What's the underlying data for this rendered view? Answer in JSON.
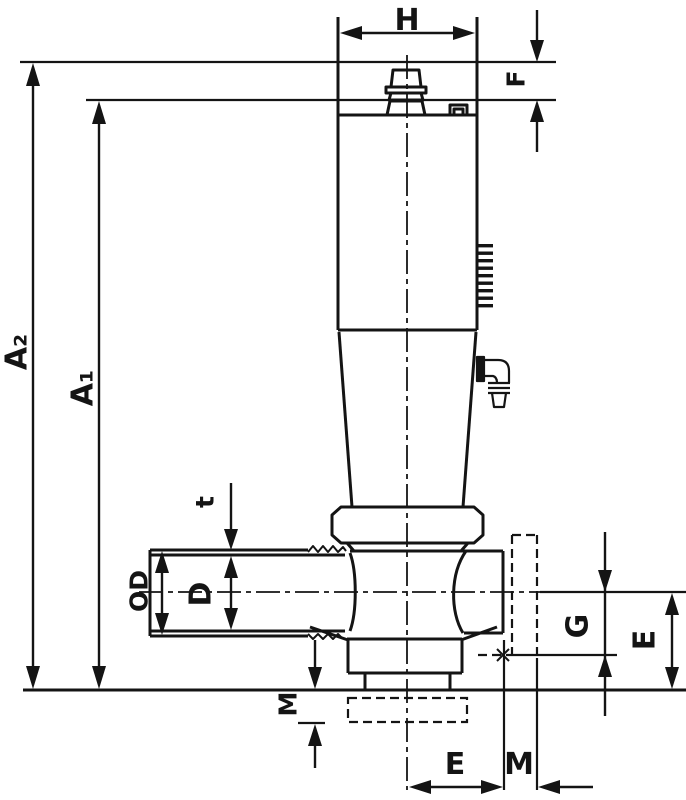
{
  "diagram": {
    "type": "technical-dimension-drawing",
    "subject": "angle-seat valve with side and bottom ports",
    "colors": {
      "line": "#141414",
      "background": "#ffffff"
    },
    "labels": {
      "H": "H",
      "F": "F",
      "A2": "A₂",
      "A1": "A₁",
      "t": "t",
      "OD": "OD",
      "D": "D",
      "G": "G",
      "E_side": "E",
      "E_bottom": "E",
      "M_side": "M",
      "M_bottom": "M"
    }
  }
}
